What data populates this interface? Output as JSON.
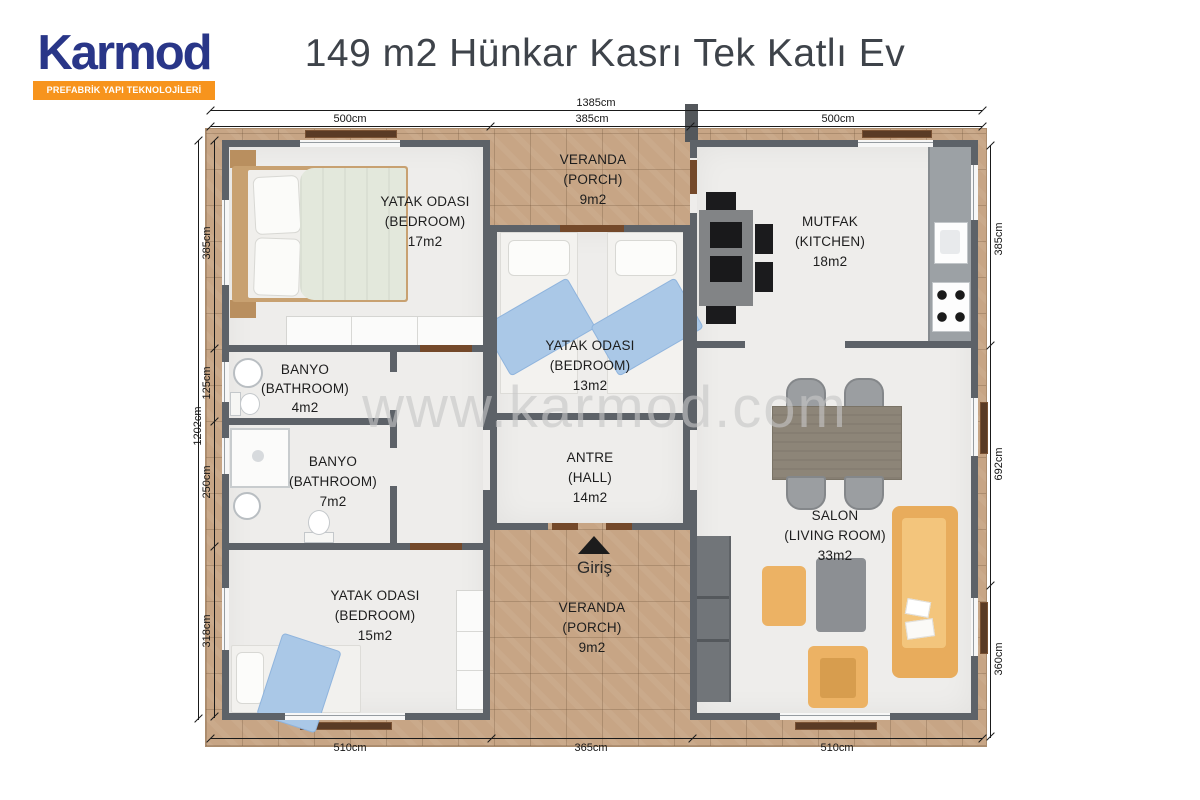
{
  "brand": {
    "name": "Karmod",
    "tagline": "PREFABRİK YAPI TEKNOLOJİLERİ"
  },
  "title": "149 m2 Hünkar Kasrı Tek Katlı Ev",
  "watermark": "www.karmod.com",
  "entrance": {
    "label": "Giriş",
    "icon": "entrance-arrow"
  },
  "dimensions": {
    "top_total": "1385cm",
    "top": [
      "500cm",
      "385cm",
      "500cm"
    ],
    "left_total": "1202cm",
    "left": [
      "385cm",
      "125cm",
      "250cm",
      "318cm"
    ],
    "right": [
      "385cm",
      "692cm",
      "360cm"
    ],
    "bottom": [
      "510cm",
      "365cm",
      "510cm"
    ]
  },
  "rooms": [
    {
      "tr": "YATAK ODASI",
      "en": "(BEDROOM)",
      "area": "17m2"
    },
    {
      "tr": "VERANDA",
      "en": "(PORCH)",
      "area": "9m2"
    },
    {
      "tr": "MUTFAK",
      "en": "(KITCHEN)",
      "area": "18m2"
    },
    {
      "tr": "BANYO",
      "en": "(BATHROOM)",
      "area": "4m2"
    },
    {
      "tr": "YATAK ODASI",
      "en": "(BEDROOM)",
      "area": "13m2"
    },
    {
      "tr": "BANYO",
      "en": "(BATHROOM)",
      "area": "7m2"
    },
    {
      "tr": "ANTRE",
      "en": "(HALL)",
      "area": "14m2"
    },
    {
      "tr": "SALON",
      "en": "(LIVING ROOM)",
      "area": "33m2"
    },
    {
      "tr": "YATAK ODASI",
      "en": "(BEDROOM)",
      "area": "15m2"
    },
    {
      "tr": "VERANDA",
      "en": "(PORCH)",
      "area": "9m2"
    }
  ],
  "colors": {
    "logo_blue": "#293688",
    "logo_orange": "#f7941d",
    "wall": "#5d6268",
    "deck_tile": "#c7a585",
    "sofa_orange": "#ecb264",
    "blanket_blue": "#aac8e7",
    "title_text": "#3e434a"
  }
}
